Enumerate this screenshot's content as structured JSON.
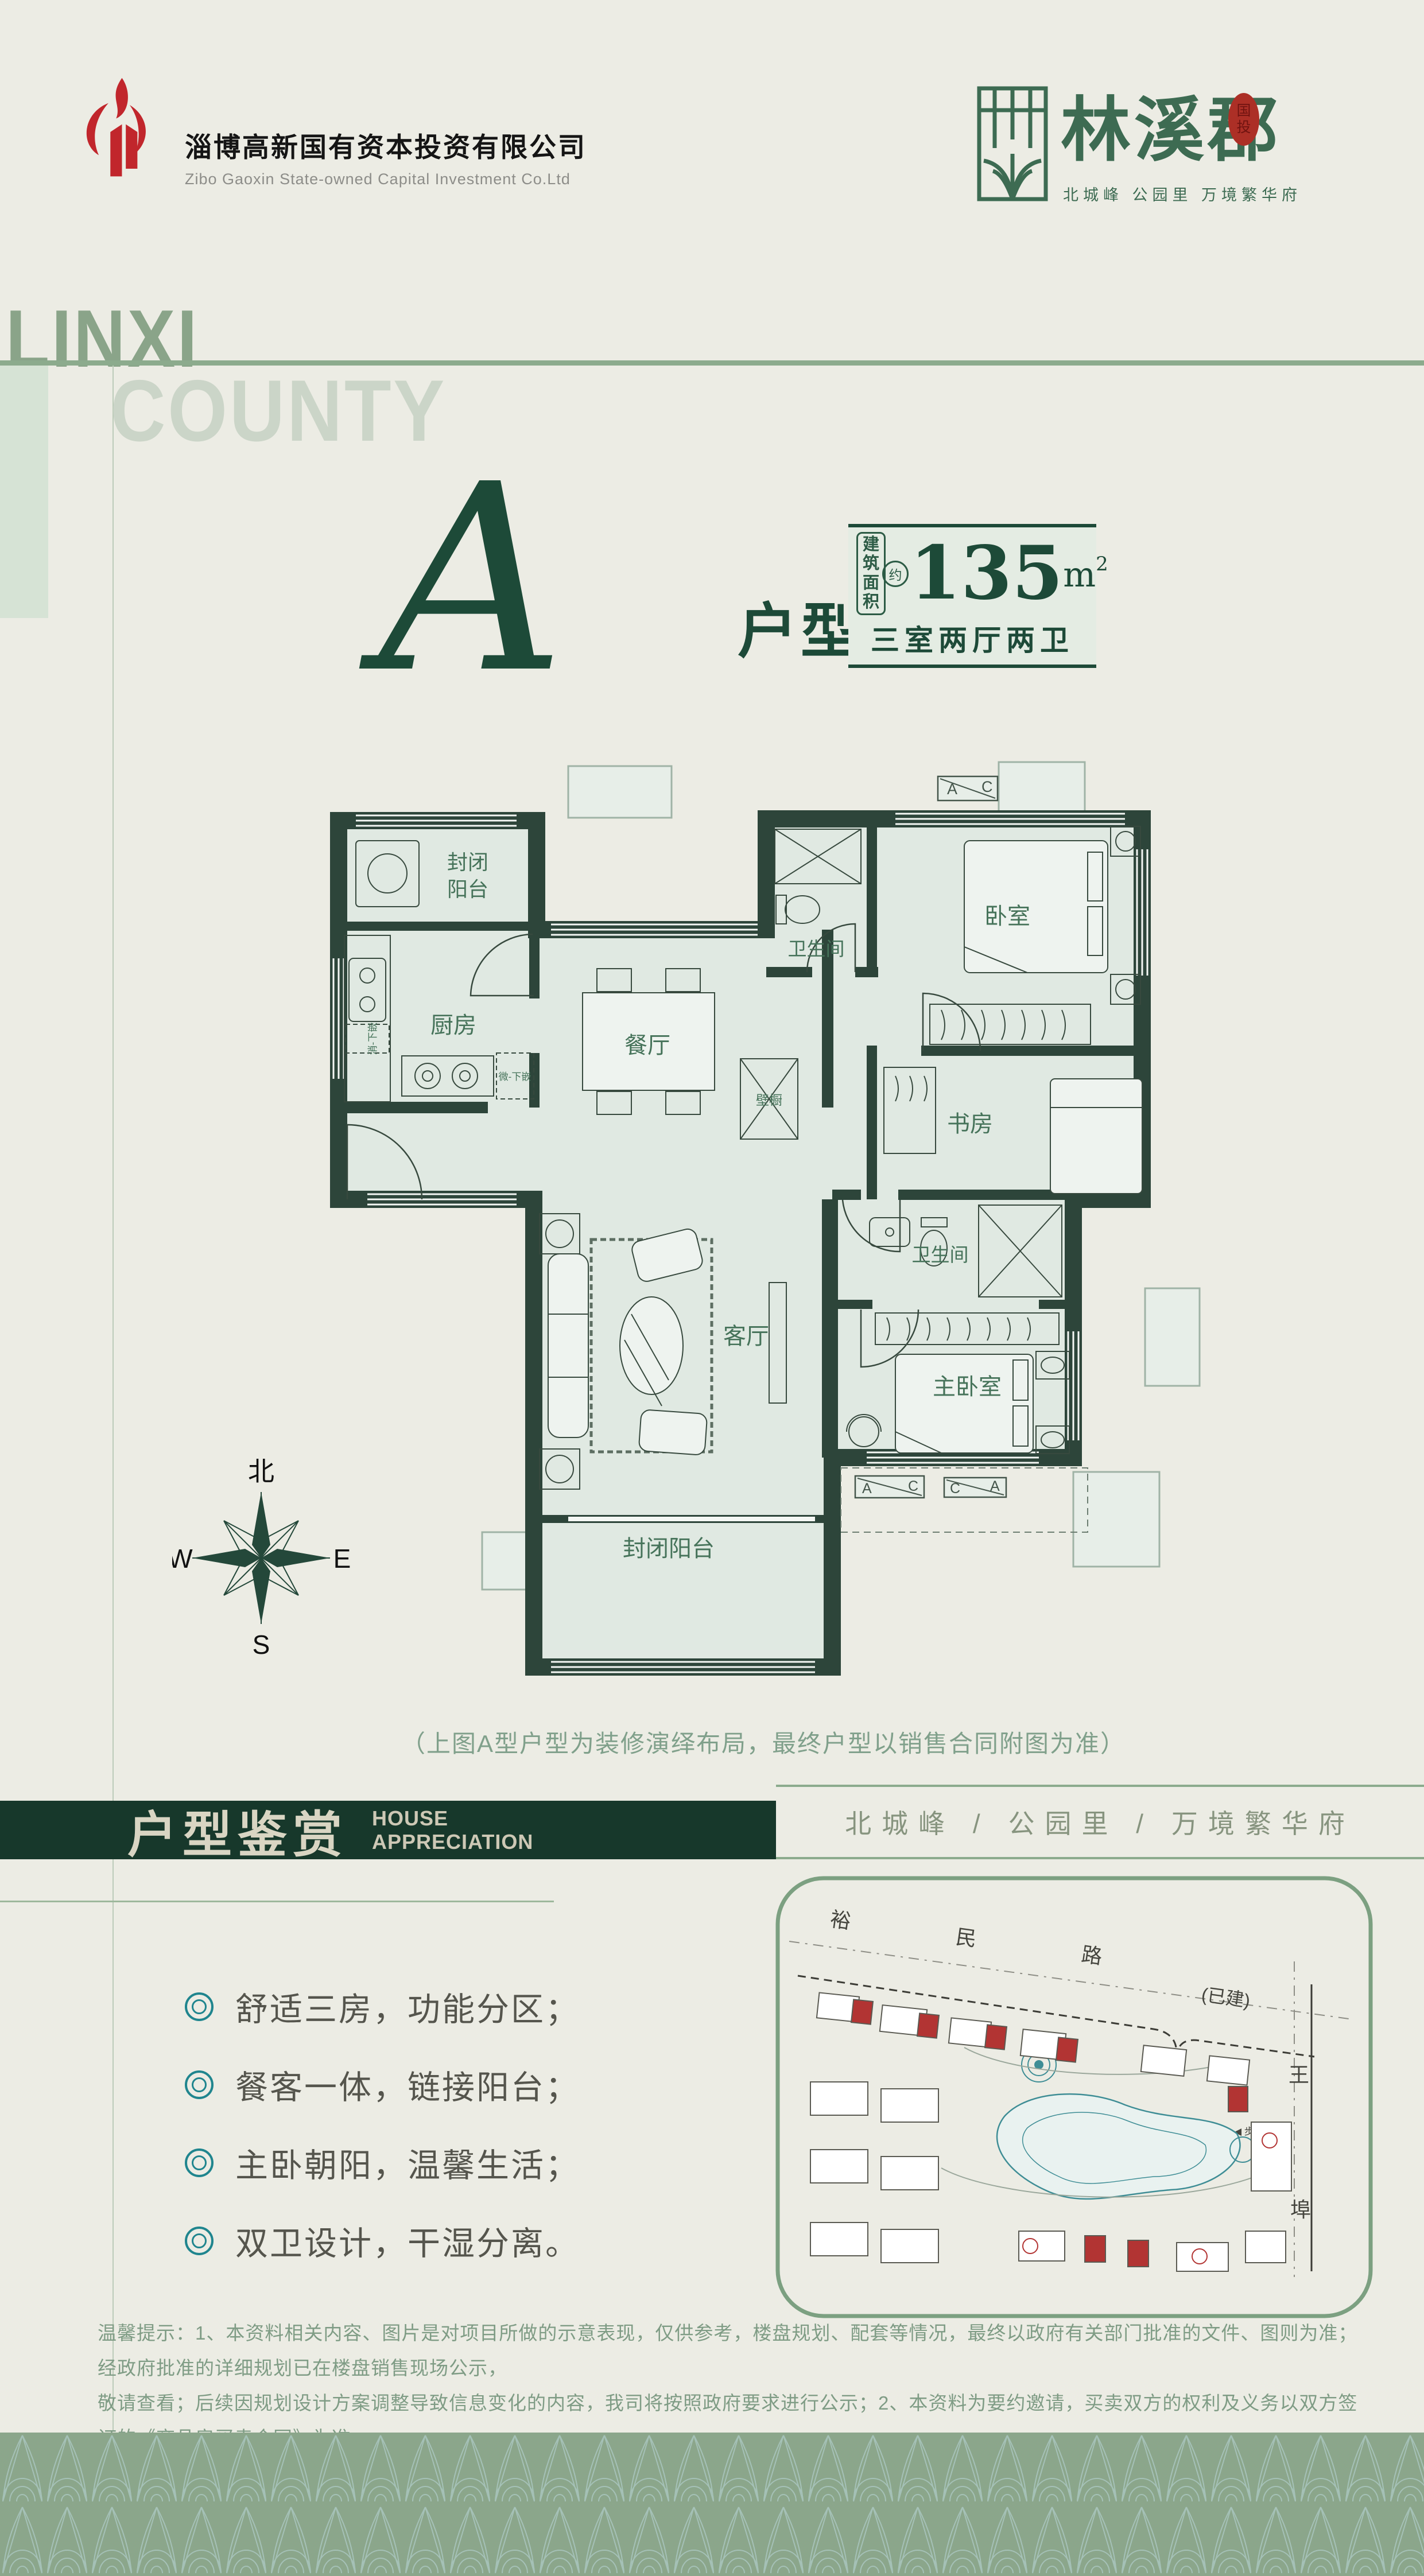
{
  "header": {
    "company_cn": "淄博高新国有资本投资有限公司",
    "company_en": "Zibo Gaoxin State-owned Capital Investment Co.Ltd",
    "brand_name": "林溪郡",
    "seal_l1": "国",
    "seal_l2": "投",
    "brand_tagline": "北城峰 公园里 万境繁华府"
  },
  "watermark": {
    "line1": "LINXI",
    "line2": "COUNTY"
  },
  "unit": {
    "letter": "A",
    "suffix": "户型",
    "area_label_l1": "建筑",
    "area_label_l2": "面积",
    "area_approx": "约",
    "area_value": "135",
    "area_unit_m": "m",
    "area_unit_exp": "2",
    "layout": "三室两厅两卫"
  },
  "floorplan": {
    "balcony_top_l1": "封闭",
    "balcony_top_l2": "阳台",
    "kitchen": "厨房",
    "note_sterilizer": "消-下嵌",
    "note_microwave": "微-下嵌",
    "dining": "餐厅",
    "bath_top": "卫生间",
    "bedroom": "卧室",
    "study": "书房",
    "closet": "壁橱",
    "living": "客厅",
    "bath_master": "卫生间",
    "master": "主卧室",
    "balcony_bottom": "封闭阳台",
    "ac_a": "A",
    "ac_c": "C"
  },
  "compass": {
    "n": "北",
    "w": "W",
    "e": "E",
    "s": "S"
  },
  "caption": "（上图A型户型为装修演绎布局，最终户型以销售合同附图为准）",
  "section": {
    "title": "户型鉴赏",
    "subtitle_l1": "HOUSE",
    "subtitle_l2": "APPRECIATION",
    "slogan": "北城峰 / 公园里 / 万境繁华府"
  },
  "features": [
    "舒适三房，功能分区；",
    "餐客一体，链接阳台；",
    "主卧朝阳，温馨生活；",
    "双卫设计，干湿分离。"
  ],
  "siteplan": {
    "road_top": "裕民路",
    "built_label": "(已建)",
    "road_right_top": "王",
    "road_right_bottom": "埠",
    "entrance": "◀ 步行入口"
  },
  "disclaimer": {
    "line1": "温馨提示：1、本资料相关内容、图片是对项目所做的示意表现，仅供参考，楼盘规划、配套等情况，最终以政府有关部门批准的文件、图则为准；经政府批准的详细规划已在楼盘销售现场公示，",
    "line2": "敬请查看；后续因规划设计方案调整导致信息变化的内容，我司将按照政府要求进行公示；2、本资料为要约邀请，买卖双方的权利及义务以双方签订的《商品房买卖合同》为准。"
  },
  "colors": {
    "page_bg": "#ecece4",
    "brand_dark_green": "#1d4a38",
    "sage": "#8cab8d",
    "bar_green": "#17382b",
    "logo_red": "#c1262c",
    "bullet_teal": "#1f858e",
    "plan_room_fill": "#e0e9e2",
    "plan_wall": "#2d453a",
    "site_red": "#b23433",
    "footer_green": "#8ba68b"
  }
}
